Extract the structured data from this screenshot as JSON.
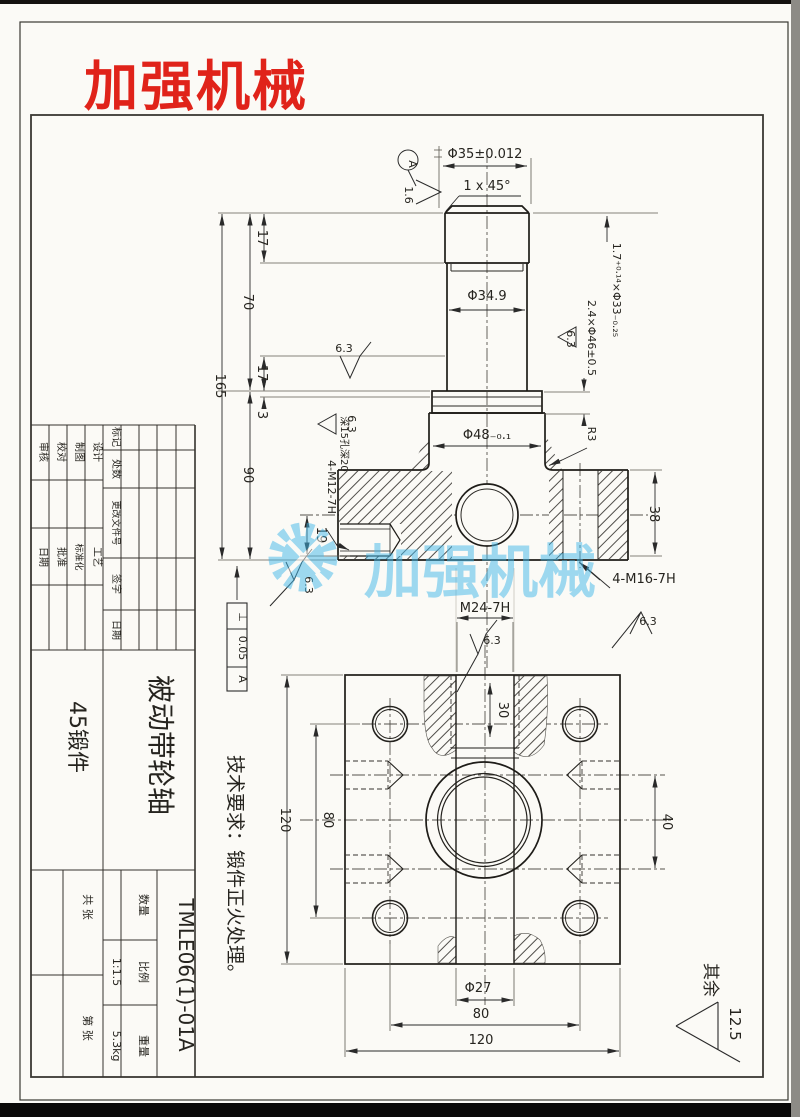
{
  "page": {
    "logo": "加强机械",
    "watermark": "加强机械"
  },
  "upper_view": {
    "datum_label": "A",
    "rough_16": "1.6",
    "dia35": "Φ35±0.012",
    "chamfer": "1 x 45°",
    "dim_17_top": "17",
    "dim_70": "70",
    "dim_165": "165",
    "dim_17_low": "17",
    "dim_3": "3",
    "dim_90": "90",
    "dia349": "Φ34.9",
    "groove_note": "1.7⁺⁰·¹⁴×Φ33₋₀.₂₅",
    "collar_note": "2.4×Φ46±0.5",
    "rough_63": "6.3",
    "dia48": "Φ48₋₀.₁",
    "r3": "R3",
    "dim_38": "38",
    "m16_note": "4-M16-7H",
    "m12_note": "4-M12-7H",
    "m12_depth": "深15孔深20",
    "dim_19": "19",
    "gdt": {
      "symbol": "⊥",
      "value": "0.05",
      "datum": "A"
    }
  },
  "lower_view": {
    "m24_note": "M24-7H",
    "rough_63": "6.3",
    "dim_30": "30",
    "dim_120_left": "120",
    "dim_80_left": "80",
    "dim_40": "40",
    "dia27": "Φ27",
    "dim_80_bottom": "80",
    "dim_120_bottom": "120"
  },
  "notes": {
    "tech_req": "技术要求：锻件正火处理。",
    "others_label": "其余",
    "others_value": "12.5"
  },
  "title_block": {
    "sign_rows": [
      "设计",
      "制图",
      "校对",
      "审核"
    ],
    "proc_rows": [
      "工艺",
      "标准化",
      "批准",
      "日期"
    ],
    "rev_headers": [
      "标记",
      "处数",
      "更改文件号",
      "签字",
      "日期"
    ],
    "material": "45锻件",
    "part_name": "被动带轮轴",
    "qty_label": "数量",
    "scale_label": "比例",
    "scale_value": "1:1.5",
    "weight_label": "重量",
    "weight_value": "5.3kg",
    "sheet_total": "共 张",
    "sheet_no": "第 张",
    "drawing_no": "TMLE06(1)-01A"
  }
}
